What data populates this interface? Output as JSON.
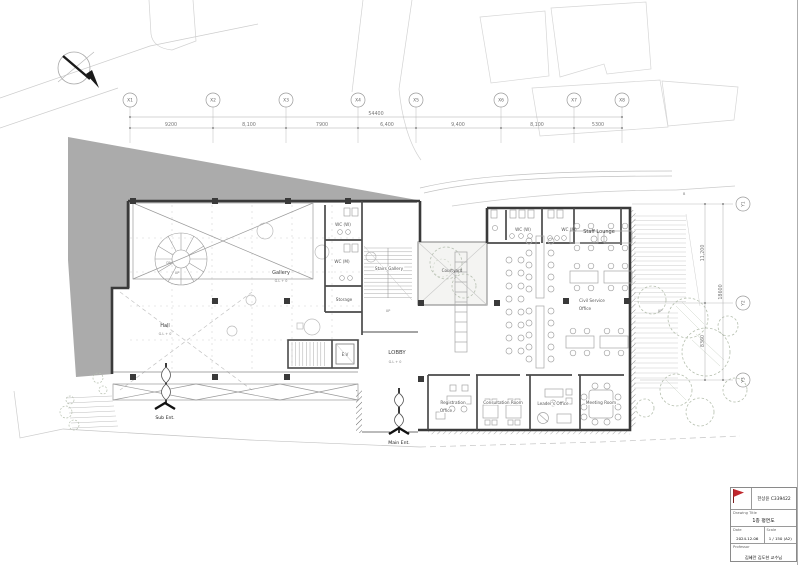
{
  "sheet": {
    "type": "architectural floor plan",
    "background": "#ffffff",
    "wall_color": "#3a3a3a",
    "site_gray": "#ababab",
    "accent_red": "#c0272d"
  },
  "grid": {
    "x": [
      "X1",
      "X2",
      "X3",
      "X4",
      "X5",
      "X6",
      "X7",
      "X8"
    ],
    "x_dims": [
      "9200",
      "8,100",
      "7900",
      "6,400",
      "9,400",
      "8,100",
      "5300"
    ],
    "x_overall": "54400",
    "y": [
      "Y1",
      "Y2",
      "Y3"
    ],
    "y_dims": [
      "11,200",
      "8360"
    ],
    "y_overall": "18600"
  },
  "labels": {
    "hall": "Hall",
    "gallery": "Gallery",
    "stairs_gallery": "Stairs Gallery",
    "courtyard": "Courtyard",
    "lobby": "LOBBY",
    "gl0": "G.L + 0",
    "storage": "Storage",
    "ev": "E.V",
    "wc_w": "WC (W)",
    "wc_m": "WC (M)",
    "staff_lounge": "Staff Lounge",
    "civil_service_1": "Civil Service",
    "civil_service_2": "Office",
    "registration_1": "Registration",
    "registration_2": "Office",
    "consultation": "Consultation Room",
    "leaders": "Leader's Office",
    "meeting": "Meeting Room",
    "sub_ent": "Sub Ent.",
    "main_ent": "Main Ent.",
    "up": "UP",
    "dn": "DN",
    "road_b": "B"
  },
  "titleblock": {
    "student": "한상윤 C339422",
    "drawing_title_label": "Drawing Title",
    "drawing_title": "1층 평면도",
    "date_label": "Date",
    "date": "2024.12.06",
    "scale_label": "Scale",
    "scale": "1 / 150 (A2)",
    "professor_label": "Professor",
    "professor": "김혜란 김도현 교수님"
  }
}
